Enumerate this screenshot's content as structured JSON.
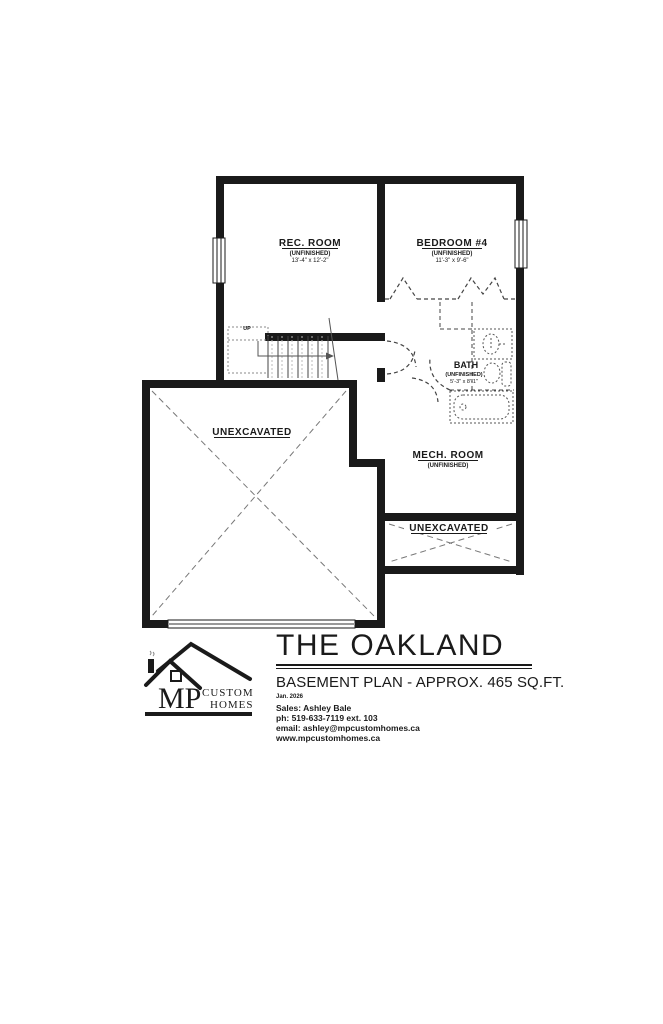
{
  "plan": {
    "rooms": {
      "rec_room": {
        "name": "REC. ROOM",
        "status": "(UNFINISHED)",
        "dims": "13'-4\" x 12'-2\""
      },
      "bedroom4": {
        "name": "BEDROOM #4",
        "status": "(UNFINISHED)",
        "dims": "11'-3\" x 9'-6\""
      },
      "bath": {
        "name": "BATH",
        "status": "(UNFINISHED)",
        "dims": "5'-3\" x 8'-1\""
      },
      "mech_room": {
        "name": "MECH. ROOM",
        "status": "(UNFINISHED)"
      },
      "unexcavated_main": {
        "label": "UNEXCAVATED"
      },
      "unexcavated_lower": {
        "label": "UNEXCAVATED"
      }
    },
    "stairs": {
      "up_label": "UP"
    }
  },
  "title_block": {
    "plan_name": "THE OAKLAND",
    "subtitle": "BASEMENT PLAN - APPROX. 465 SQ.FT.",
    "date": "Jan. 2026",
    "sales": "Sales: Ashley Bale",
    "phone": "ph: 519-633-7119 ext. 103",
    "email": "email: ashley@mpcustomhomes.ca",
    "website": "www.mpcustomhomes.ca"
  },
  "logo": {
    "initials": "MP",
    "word1": "CUSTOM",
    "word2": "HOMES"
  },
  "colors": {
    "wall": "#1a1a1a",
    "dashed": "#555555",
    "hatch": "#777777",
    "background": "#ffffff"
  }
}
